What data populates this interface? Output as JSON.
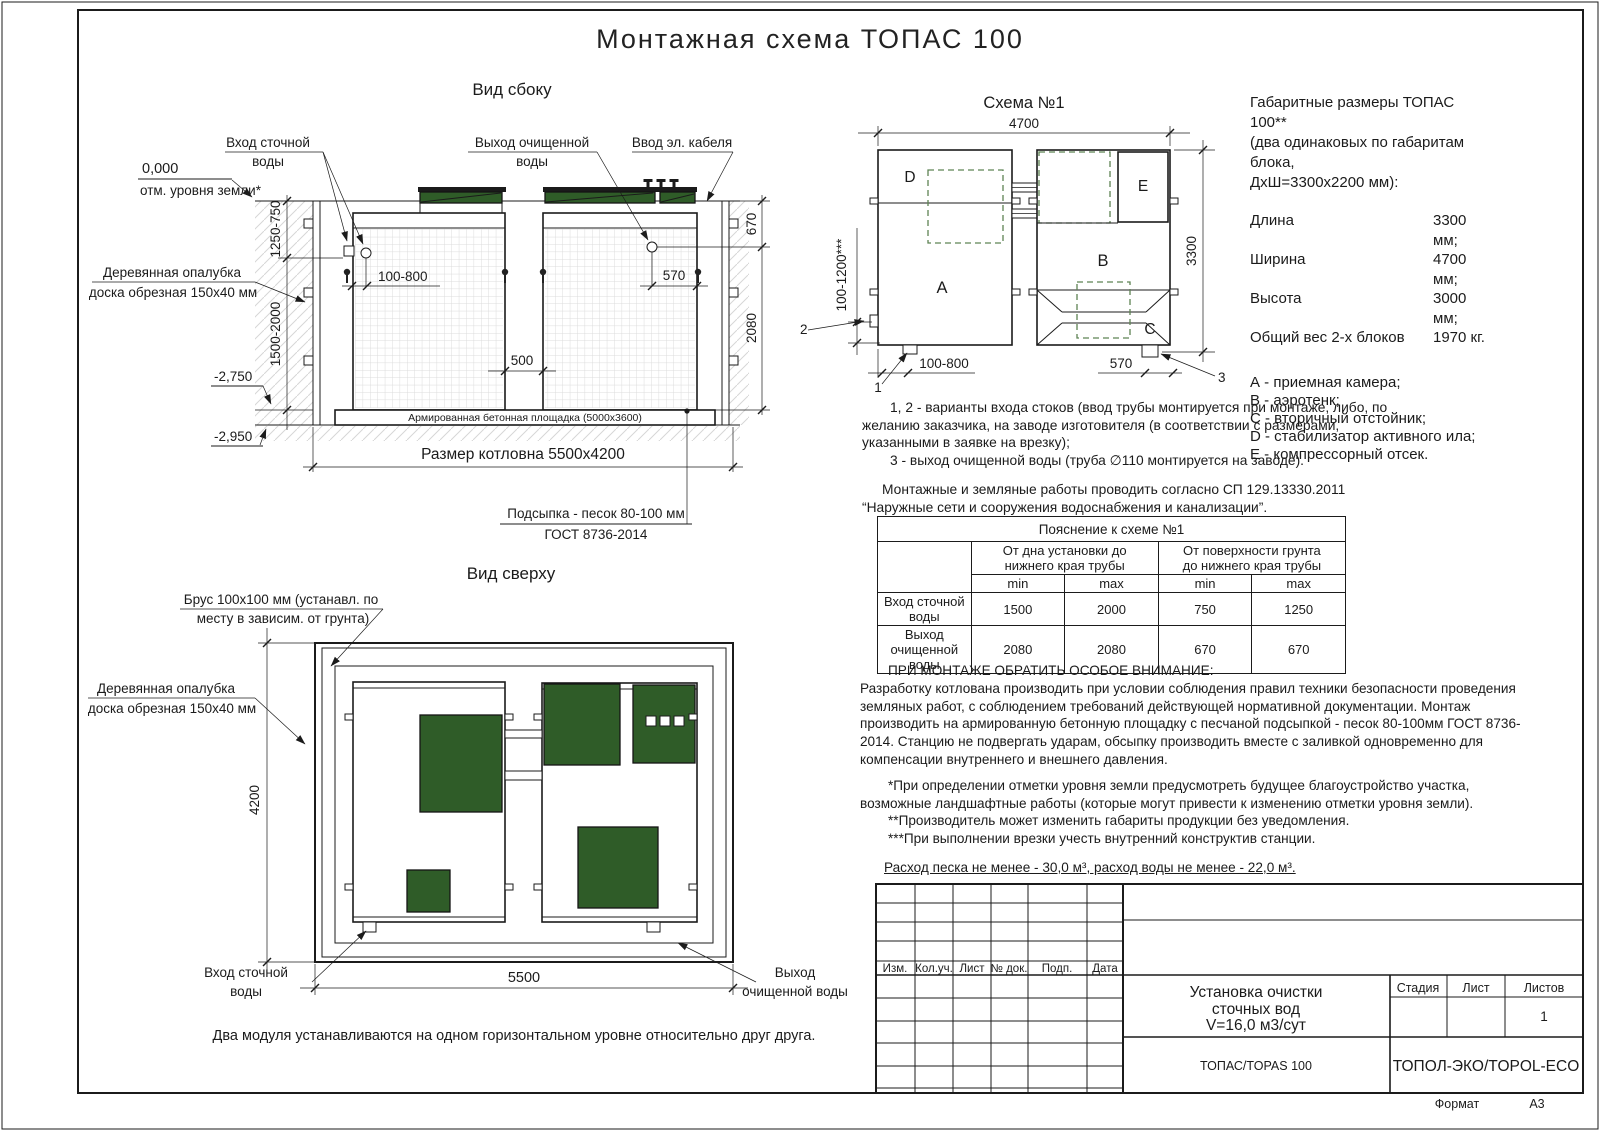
{
  "title": "Монтажная схема ТОПАС 100",
  "side_view": {
    "label": "Вид сбоку",
    "zero_mark": "0,000",
    "ground_note": "отм. уровня земли*",
    "inlet_line1": "Вход сточной",
    "inlet_line2": "воды",
    "outlet_line1": "Выход очищенной",
    "outlet_line2": "воды",
    "cable_label": "Ввод эл. кабеля",
    "formwork_line1": "Деревянная опалубка",
    "formwork_line2": "доска обрезная 150х40 мм",
    "dim_cover": "1250-750",
    "dim_depth": "1500-2000",
    "level_1": "-2,750",
    "level_2": "-2,950",
    "dim_inlet": "100-800",
    "dim_outlet": "570",
    "dim_top": "670",
    "dim_body": "2080",
    "dim_gap": "500",
    "slab_label": "Армированная бетонная площадка (5000х3600)",
    "pit_label": "Размер котловна 5500х4200",
    "bedding_line1": "Подсыпка - песок 80-100 мм",
    "bedding_line2": "ГОСТ 8736-2014"
  },
  "schema": {
    "label": "Схема №1",
    "dim_width": "4700",
    "dim_height": "3300",
    "dim_left": "100-1200***",
    "dim_inlet": "100-800",
    "dim_outlet": "570",
    "marker_1": "1",
    "marker_2": "2",
    "marker_3": "3",
    "block_a": "A",
    "block_b": "B",
    "block_c": "C",
    "block_d": "D",
    "block_e": "E"
  },
  "specs": {
    "title_line1": "Габаритные размеры ТОПАС 100**",
    "title_line2": "(два одинаковых по габаритам блока,",
    "title_line3": "ДхШ=3300х2200 мм):",
    "rows": [
      {
        "name": "Длина",
        "value": "3300 мм;"
      },
      {
        "name": "Ширина",
        "value": "4700 мм;"
      },
      {
        "name": "Высота",
        "value": "3000 мм;"
      },
      {
        "name": "Общий вес 2-х блоков",
        "value": "1970 кг."
      }
    ],
    "legend": [
      "А - приемная камера;",
      "В - аэротенк;",
      "С - вторичный отстойник;",
      "D - стабилизатор активного ила;",
      "Е - компрессорный отсек."
    ]
  },
  "notes": {
    "para1": "1, 2 - варианты входа  стоков (ввод трубы монтируется при монтаже, либо, по желанию заказчика, на заводе изготовителя (в соответствии с размерами, указанными в заявке на врезку);",
    "para2": "3 - выход очищенной воды (труба ∅110 монтируется на заводе).",
    "para3": "Монтажные и земляные работы проводить согласно СП 129.13330.2011 “Наружные сети и сооружения водоснабжения и канализации”."
  },
  "table": {
    "title": "Пояснение к схеме №1",
    "group1_line1": "От дна установки до",
    "group1_line2": "нижнего края трубы",
    "group2_line1": "От поверхности грунта",
    "group2_line2": "до нижнего края трубы",
    "min_label": "min",
    "max_label": "max",
    "rows": [
      {
        "name": "Вход сточной воды",
        "c1": "1500",
        "c2": "2000",
        "c3": "750",
        "c4": "1250"
      },
      {
        "name": "Выход очищенной воды",
        "c1": "2080",
        "c2": "2080",
        "c3": "670",
        "c4": "670"
      }
    ]
  },
  "attention": {
    "title": "ПРИ МОНТАЖЕ ОБРАТИТЬ ОСОБОЕ ВНИМАНИЕ:",
    "body": "Разработку котлована производить при условии соблюдения правил техники безопасности проведения земляных работ, с соблюдением требований действующей нормативной документации.  Монтаж производить на армированную бетонную площадку с песчаной подсыпкой - песок 80-100мм ГОСТ 8736-2014. Станцию не подвергать ударам, обсыпку производить вместе с заливкой одновременно для компенсации внутреннего и внешнего давления.",
    "note1": "*При определении отметки уровня земли предусмотреть будущее благоустройство участка, возможные ландшафтные работы (которые могут привести к изменению отметки уровня земли).",
    "note2": "**Производитель может изменить габариты продукции без уведомления.",
    "note3": "***При выполнении врезки учесть внутренний конструктив станции.",
    "consumption": "Расход песка не менее - 30,0 м³, расход воды не менее - 22,0 м³."
  },
  "top_view": {
    "label": "Вид сверху",
    "beam_line1": "Брус 100х100 мм (устанавл. по",
    "beam_line2": "месту в зависим. от грунта)",
    "formwork_line1": "Деревянная опалубка",
    "formwork_line2": "доска обрезная 150х40 мм",
    "dim_height": "4200",
    "dim_width": "5500",
    "inlet_line1": "Вход сточной",
    "inlet_line2": "воды",
    "outlet_line1": "Выход",
    "outlet_line2": "очищенной воды",
    "note": "Два модуля устанавливаются на одном горизонтальном уровне относительно друг друга."
  },
  "stamp": {
    "col_headers": [
      "Изм.",
      "Кол.уч.",
      "Лист",
      "№ док.",
      "Подп.",
      "Дата"
    ],
    "doc_line1": "Установка очистки",
    "doc_line2": "сточных вод",
    "doc_line3": "V=16,0 м3/сут",
    "stage_label": "Стадия",
    "sheet_label": "Лист",
    "sheets_label": "Листов",
    "sheets_value": "1",
    "product": "ТОПАС/TOPAS 100",
    "company": "ТОПОЛ-ЭКО/TOPOL-ECO",
    "format_label": "Формат",
    "format_value": "А3"
  },
  "colors": {
    "line": "#1b1b1b",
    "lid_green": "#2f5c28",
    "dashed_green": "#5d8353"
  }
}
